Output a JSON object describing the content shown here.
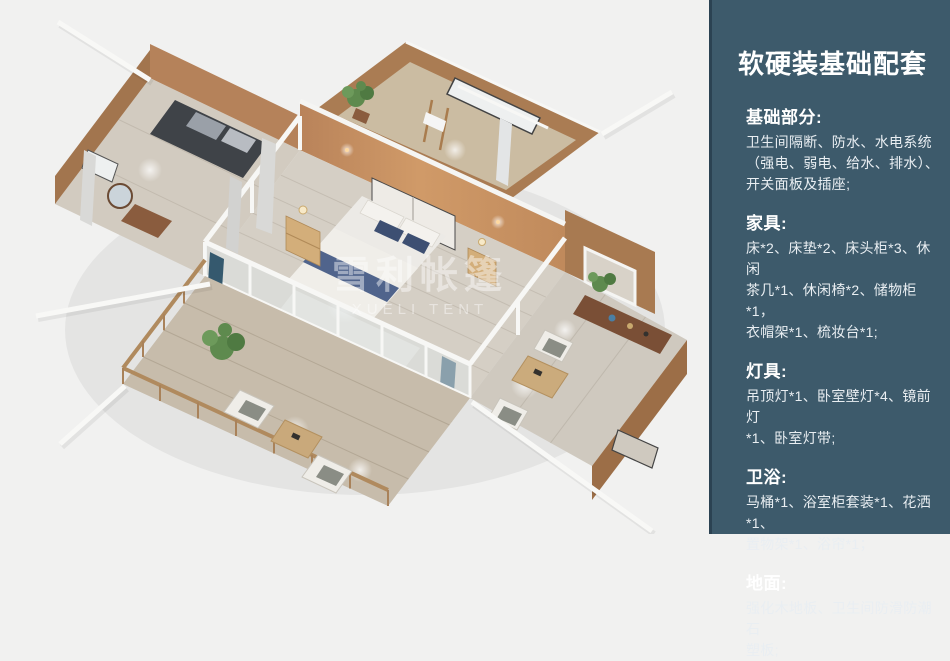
{
  "theme": {
    "canvas_bg": "#f1f1f0",
    "panel_bg": "#3d5a6b",
    "panel_border": "#2b4252",
    "panel_heading_text": "#ffffff",
    "panel_body_text": "#e9eef2",
    "wall_dark": "#a2754e",
    "wall_mid": "#b5825a",
    "wall_light": "#c9935f",
    "floor_wood": "#d5cfc5",
    "deck_wood": "#c7bcab",
    "bed_white": "#eceae6",
    "bed_runner_blue": "#50648c",
    "curtain_teal": "#35596e",
    "plant_green": "#5e8a4e",
    "frame_white": "#f7f7f5"
  },
  "render": {
    "description": "Bird's-eye 3D render of a glamping tent suite: central bedroom with double bed, bathroom wing, wardrobe wing, tea-table wing and wooden deck",
    "watermark_cn": "雪利帐篷",
    "watermark_en": "XUELI TENT"
  },
  "panel": {
    "title": "软硬装基础配套",
    "sections": [
      {
        "heading": "基础部分:",
        "lines": [
          "卫生间隔断、防水、水电系统",
          "（强电、弱电、给水、排水）、",
          "开关面板及插座;"
        ]
      },
      {
        "heading": "家具:",
        "lines": [
          "床*2、床垫*2、床头柜*3、休闲",
          "茶几*1、休闲椅*2、储物柜*1，",
          "衣帽架*1、梳妆台*1;"
        ]
      },
      {
        "heading": "灯具:",
        "lines": [
          "吊顶灯*1、卧室壁灯*4、镜前灯",
          "*1、卧室灯带;"
        ]
      },
      {
        "heading": "卫浴:",
        "lines": [
          "马桶*1、浴室柜套装*1、花洒*1、",
          "置物架*1、浴帘*1；"
        ]
      },
      {
        "heading": "地面:",
        "lines": [
          "强化木地板、卫生间防滑防潮石",
          "塑板;"
        ]
      }
    ]
  }
}
